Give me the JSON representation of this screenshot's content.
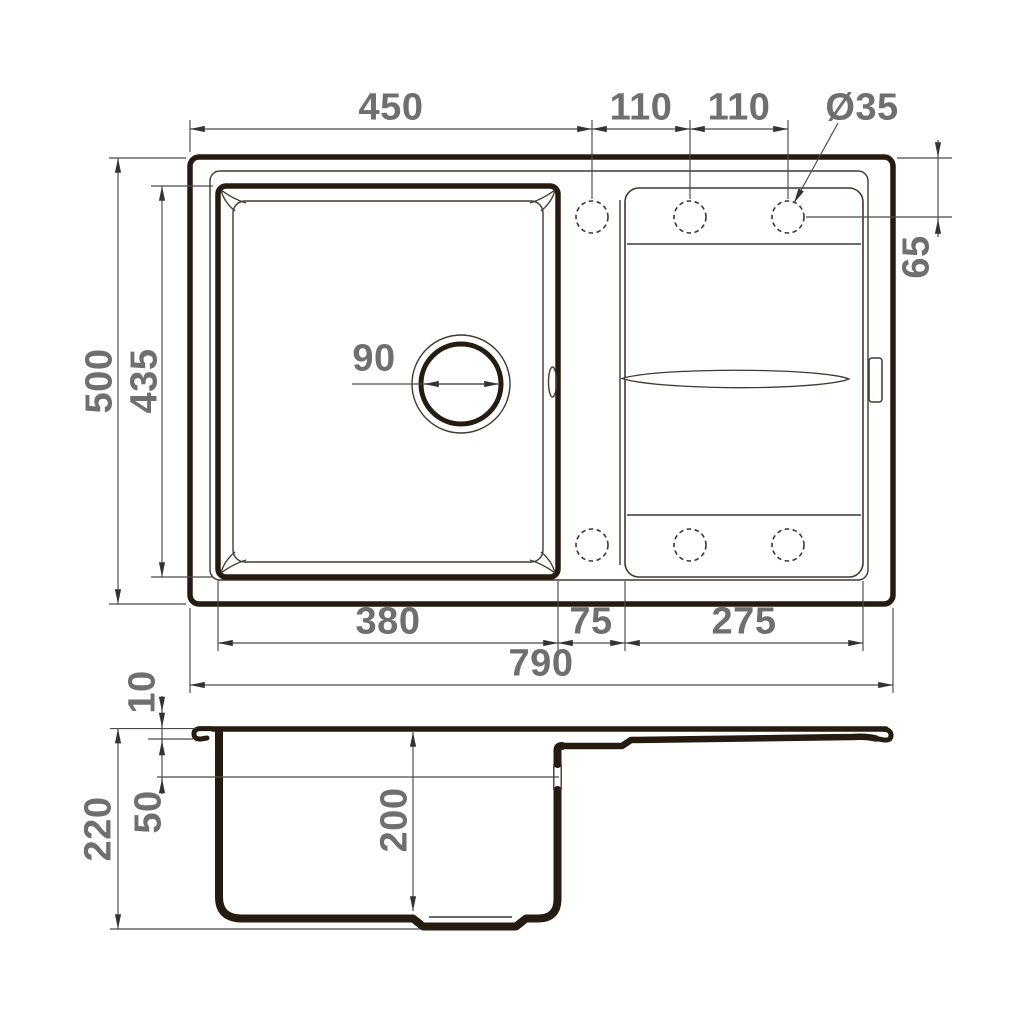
{
  "drawing": {
    "title": "kitchen-sink-dimension-drawing",
    "background": "#ffffff",
    "line_color": "#261b10",
    "dim_color": "#4a4a4a",
    "label_color": "#6f6f6f"
  },
  "top_view": {
    "edge_to_first_hole": "450",
    "hole_spacing_1": "110",
    "hole_spacing_2": "110",
    "hole_diameter": "Ø35",
    "hole_center_offset": "65",
    "overall_depth": "500",
    "bowl_inner_depth": "435",
    "drain_diameter": "90",
    "bowl_width": "380",
    "center_gap": "75",
    "drainboard_width": "275",
    "overall_width": "790"
  },
  "side_view": {
    "rim_height": "10",
    "overflow_offset": "50",
    "overall_height": "220",
    "bowl_depth": "200"
  }
}
